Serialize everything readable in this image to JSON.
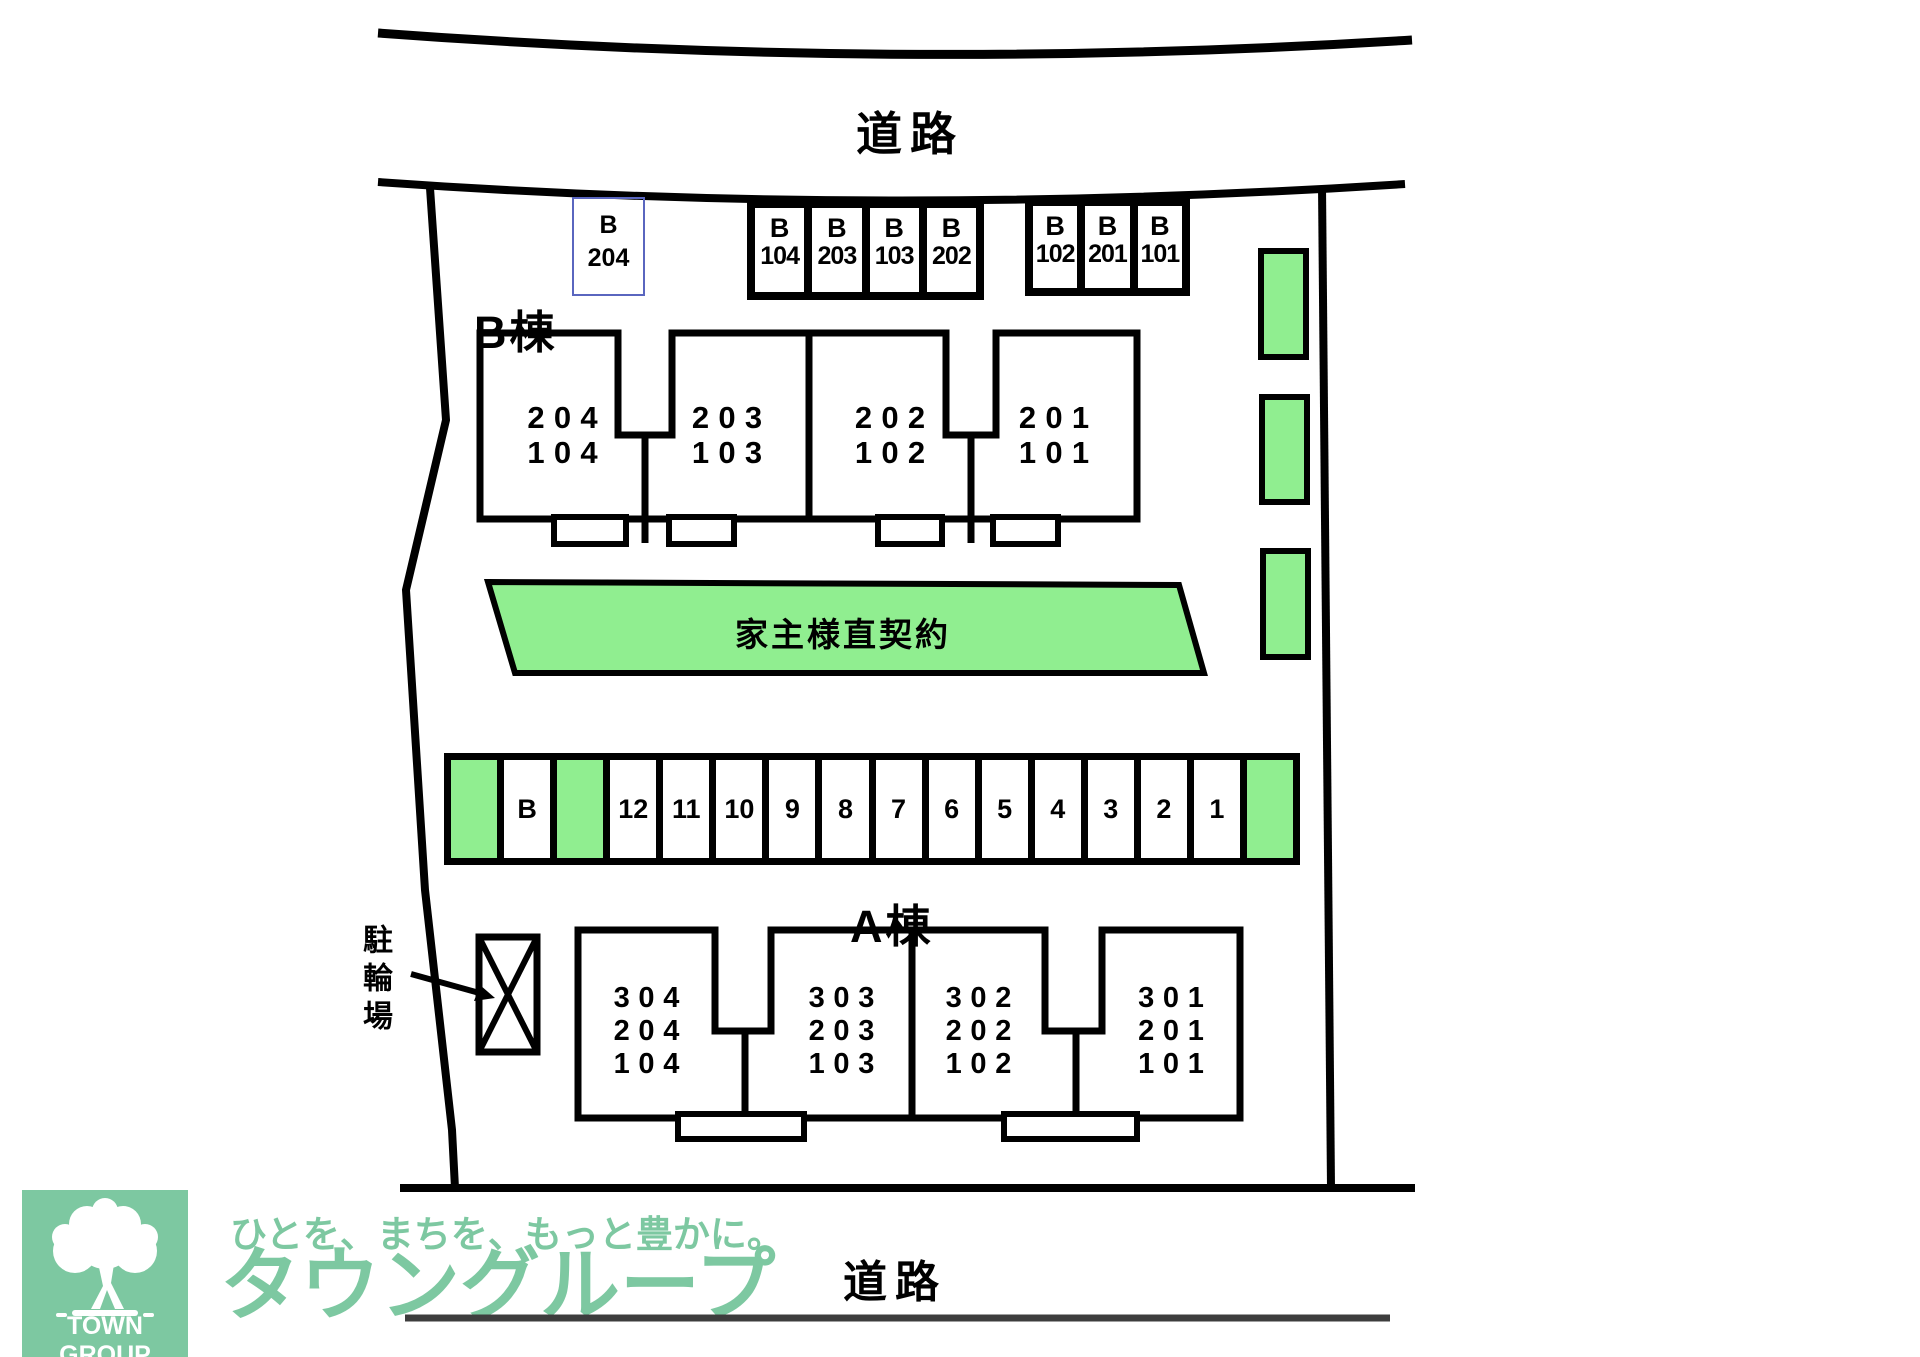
{
  "colors": {
    "plan_green": "#90ee90",
    "highlight_blue": "#5a66bf",
    "brand_green": "#7dc8a1",
    "road_gray": "#3d3d3d"
  },
  "roads": {
    "top": "道路",
    "bottom": "道路"
  },
  "highlight_stall": {
    "line1": "B",
    "line2": "204"
  },
  "top_parking": {
    "left_group": [
      {
        "line1": "B",
        "line2": "104"
      },
      {
        "line1": "B",
        "line2": "203"
      },
      {
        "line1": "B",
        "line2": "103"
      },
      {
        "line1": "B",
        "line2": "202"
      }
    ],
    "right_group": [
      {
        "line1": "B",
        "line2": "102"
      },
      {
        "line1": "B",
        "line2": "201"
      },
      {
        "line1": "B",
        "line2": "101"
      }
    ]
  },
  "building_b": {
    "name": "B棟",
    "units": [
      {
        "lines": [
          "204",
          "104"
        ]
      },
      {
        "lines": [
          "203",
          "103"
        ]
      },
      {
        "lines": [
          "202",
          "102"
        ]
      },
      {
        "lines": [
          "201",
          "101"
        ]
      }
    ]
  },
  "building_a": {
    "name": "A棟",
    "units": [
      {
        "lines": [
          "304",
          "204",
          "104"
        ]
      },
      {
        "lines": [
          "303",
          "203",
          "103"
        ]
      },
      {
        "lines": [
          "302",
          "202",
          "102"
        ]
      },
      {
        "lines": [
          "301",
          "201",
          "101"
        ]
      }
    ]
  },
  "owner_strip": {
    "label": "家主様直契約"
  },
  "middle_parking": {
    "stalls": [
      {
        "label": "",
        "green": true
      },
      {
        "label": "B",
        "green": false
      },
      {
        "label": "",
        "green": true
      },
      {
        "label": "12",
        "green": false
      },
      {
        "label": "11",
        "green": false
      },
      {
        "label": "10",
        "green": false
      },
      {
        "label": "9",
        "green": false
      },
      {
        "label": "8",
        "green": false
      },
      {
        "label": "7",
        "green": false
      },
      {
        "label": "6",
        "green": false
      },
      {
        "label": "5",
        "green": false
      },
      {
        "label": "4",
        "green": false
      },
      {
        "label": "3",
        "green": false
      },
      {
        "label": "2",
        "green": false
      },
      {
        "label": "1",
        "green": false
      },
      {
        "label": "",
        "green": true
      }
    ]
  },
  "bicycle": {
    "label": "駐輪場"
  },
  "logo": {
    "brand": "TOWN GROUP",
    "tagline": "ひとを、まちを、もっと豊かに。",
    "company": "タウングループ"
  }
}
